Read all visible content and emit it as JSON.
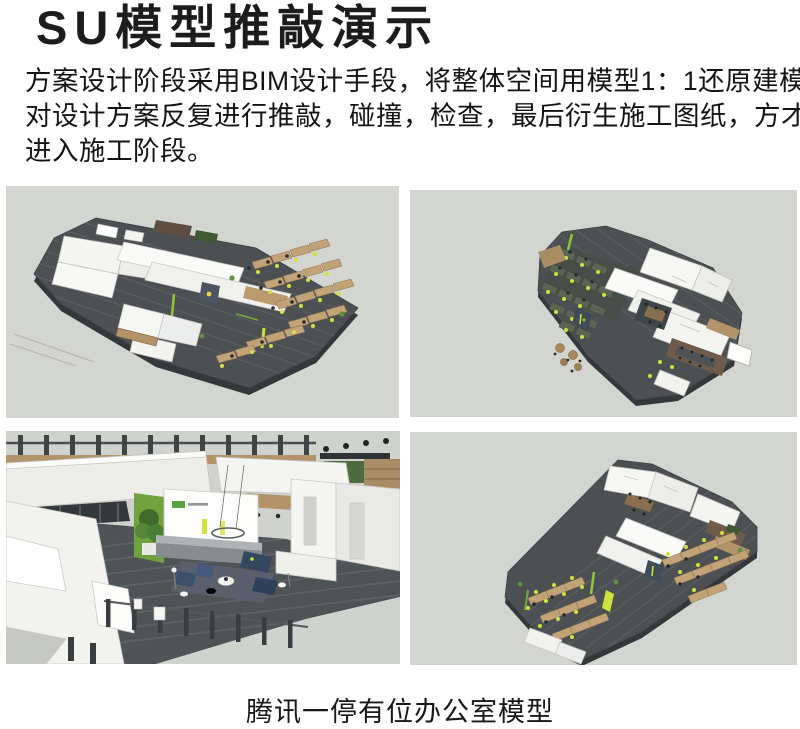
{
  "page": {
    "title": "SU模型推敲演示",
    "paragraph_lines": [
      "方案设计阶段采用BIM设计手段，将整体空间用模型1：1还原建模，",
      "对设计方案反复进行推敲，碰撞，检查，最后衍生施工图纸，方才",
      "进入施工阶段。"
    ],
    "caption": "腾讯一停有位办公室模型"
  },
  "figures": [
    {
      "id": "model-aerial-view-1"
    },
    {
      "id": "model-aerial-view-2"
    },
    {
      "id": "model-lobby-interior-view"
    },
    {
      "id": "model-aerial-view-3"
    }
  ],
  "colors": {
    "panel_background": "#d3d5d0",
    "floor_dark": "#4b5052",
    "wall_white": "#f6f6f3",
    "wood": "#c2a277",
    "accent_green": "#6fae3c",
    "accent_lime": "#cfe23f",
    "text": "#1a1a1a"
  }
}
